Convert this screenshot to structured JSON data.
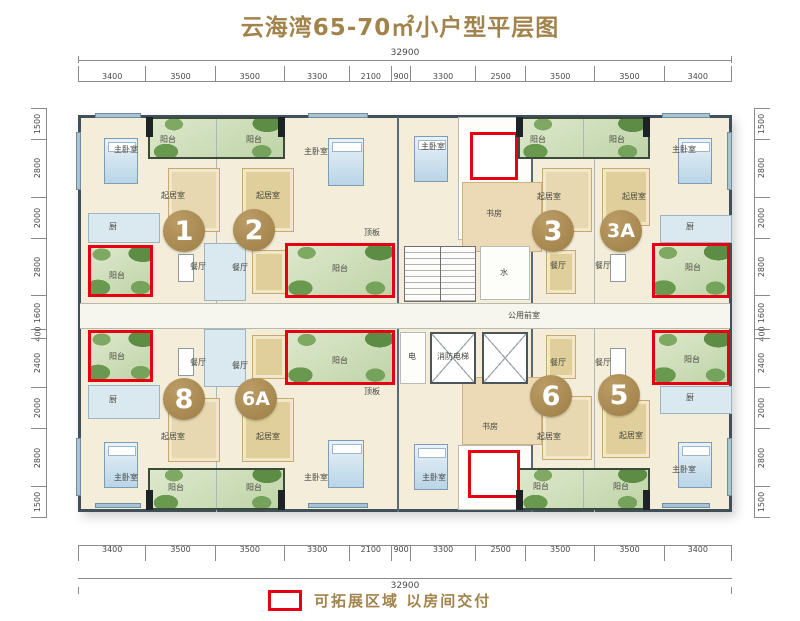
{
  "title": "云海湾65-70㎡小户型平层图",
  "legend": {
    "label": "可拓展区域  以房间交付"
  },
  "dimensions": {
    "total_top": "32900",
    "total_bottom": "32900",
    "top": [
      "3400",
      "3500",
      "3500",
      "3300",
      "2100",
      "900",
      "3300",
      "2500",
      "3500",
      "3500",
      "3400"
    ],
    "bottom": [
      "3400",
      "3500",
      "3500",
      "3300",
      "2100",
      "900",
      "3300",
      "2500",
      "3500",
      "3500",
      "3400"
    ],
    "left": [
      "1500",
      "2800",
      "2000",
      "2800",
      "1600",
      "400",
      "2400",
      "2000",
      "2800",
      "1500"
    ],
    "right": [
      "1500",
      "2800",
      "2000",
      "2800",
      "1600",
      "400",
      "2400",
      "2000",
      "2800",
      "1500"
    ]
  },
  "units": {
    "u1": "1",
    "u2": "2",
    "u3": "3",
    "u3a": "3A",
    "u8": "8",
    "u6a": "6A",
    "u6": "6",
    "u5": "5"
  },
  "rooms": {
    "u1": {
      "master": "主卧室",
      "living": "起居室",
      "dining": "餐厅",
      "kitchen": "厨",
      "balcony_top": "阳台",
      "balcony_exp": "阳台"
    },
    "u2": {
      "master": "主卧室",
      "living": "起居室",
      "dining": "餐厅",
      "balcony_top": "阳台",
      "balcony_exp": "阳台"
    },
    "u3": {
      "master": "主卧室",
      "study": "书房",
      "living": "起居室",
      "dining": "餐厅",
      "balcony_top": "阳台"
    },
    "u3a": {
      "master": "主卧室",
      "living": "起居室",
      "dining": "餐厅",
      "kitchen": "厨",
      "balcony_top": "阳台",
      "balcony_exp": "阳台"
    },
    "u8": {
      "master": "主卧室",
      "living": "起居室",
      "dining": "餐厅",
      "kitchen": "厨",
      "balcony_bottom": "阳台",
      "balcony_exp": "阳台"
    },
    "u6a": {
      "master": "主卧室",
      "living": "起居室",
      "dining": "餐厅",
      "balcony_bottom": "阳台",
      "balcony_exp": "阳台"
    },
    "u6": {
      "master": "主卧室",
      "study": "书房",
      "living": "起居室",
      "dining": "餐厅",
      "balcony_bottom": "阳台"
    },
    "u5": {
      "master": "主卧室",
      "living": "起居室",
      "dining": "餐厅",
      "kitchen": "厨",
      "balcony_bottom": "阳台",
      "balcony_exp": "阳台"
    },
    "core": {
      "water": "水",
      "electric": "电",
      "lobby": "公用前室",
      "fire_elevator": "消防电梯",
      "slab": "顶板"
    }
  },
  "colors": {
    "accent_gold": "#a1834b",
    "expand_red": "#e60012",
    "balcony_green": "#bfd4a8",
    "wall": "#40505a"
  }
}
